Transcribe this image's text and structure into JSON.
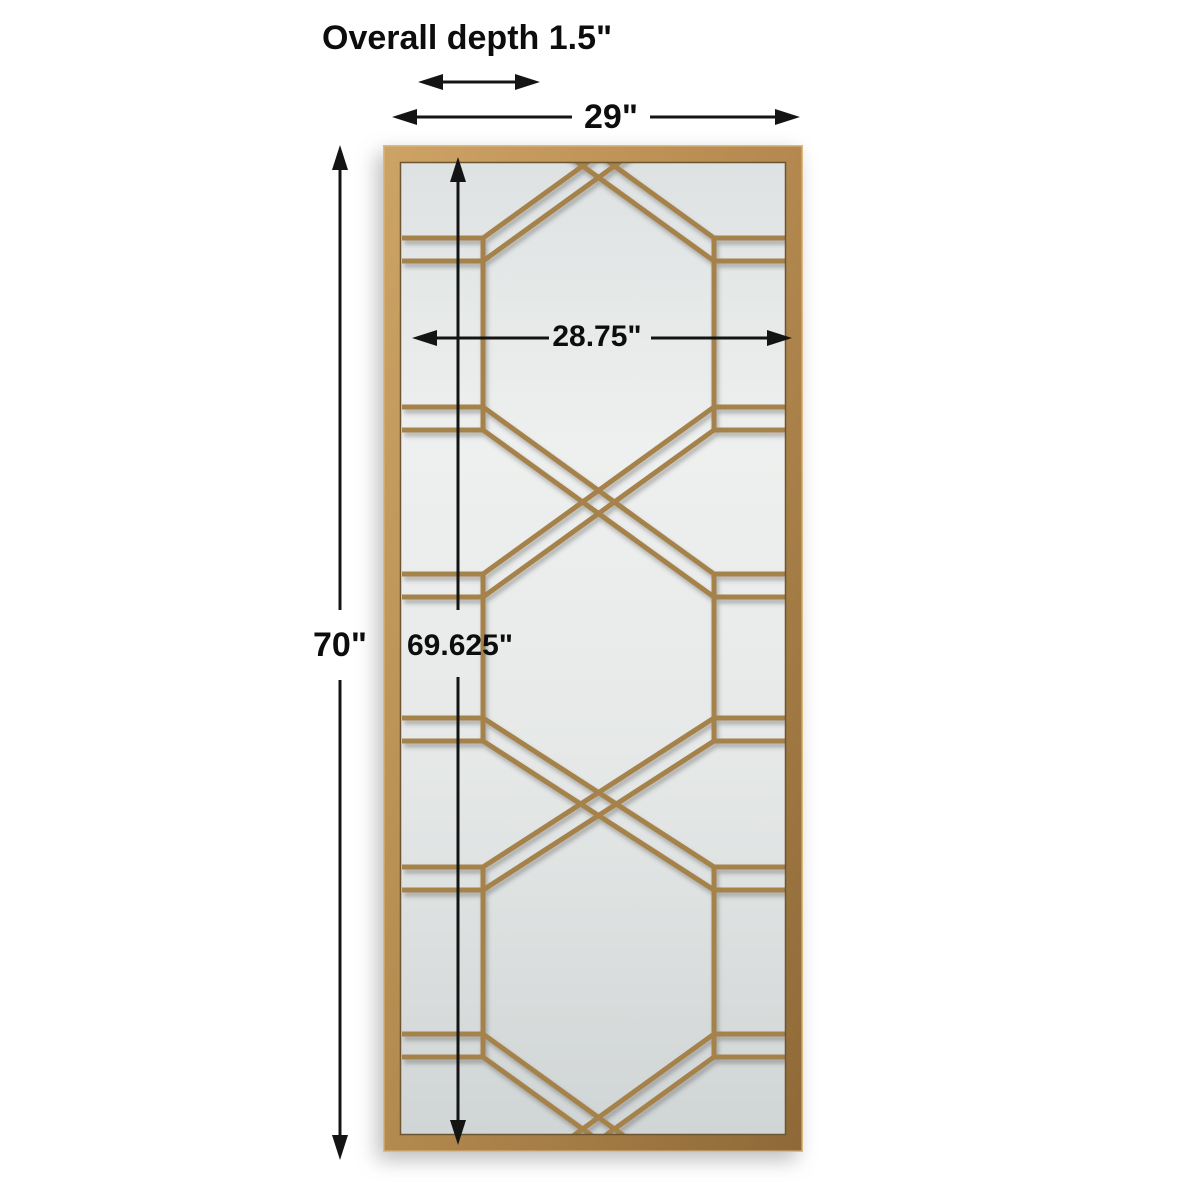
{
  "annotations": {
    "overall_depth": "Overall depth 1.5\"",
    "overall_width": "29\"",
    "overall_height": "70\"",
    "mirror_height": "69.625\"",
    "mirror_width": "28.75\""
  },
  "figure": {
    "description_labels": [
      "gold-frame-leaner-mirror"
    ],
    "pattern": "octagon-lattice-with-x-crossings"
  },
  "colors": {
    "line": "#141414",
    "text": "#0d0d0d",
    "frame_gold": "#b3894f",
    "frame_gold_light": "#cda265",
    "frame_gold_dark": "#8f6a38",
    "pattern_gold": "#a6824b",
    "frame_edge": "#6e5531",
    "frame_highlight": "#dcb980",
    "glass_top": "#dde1e1",
    "glass_light": "#eef0ef",
    "glass_bottom": "#cfd4d4"
  }
}
